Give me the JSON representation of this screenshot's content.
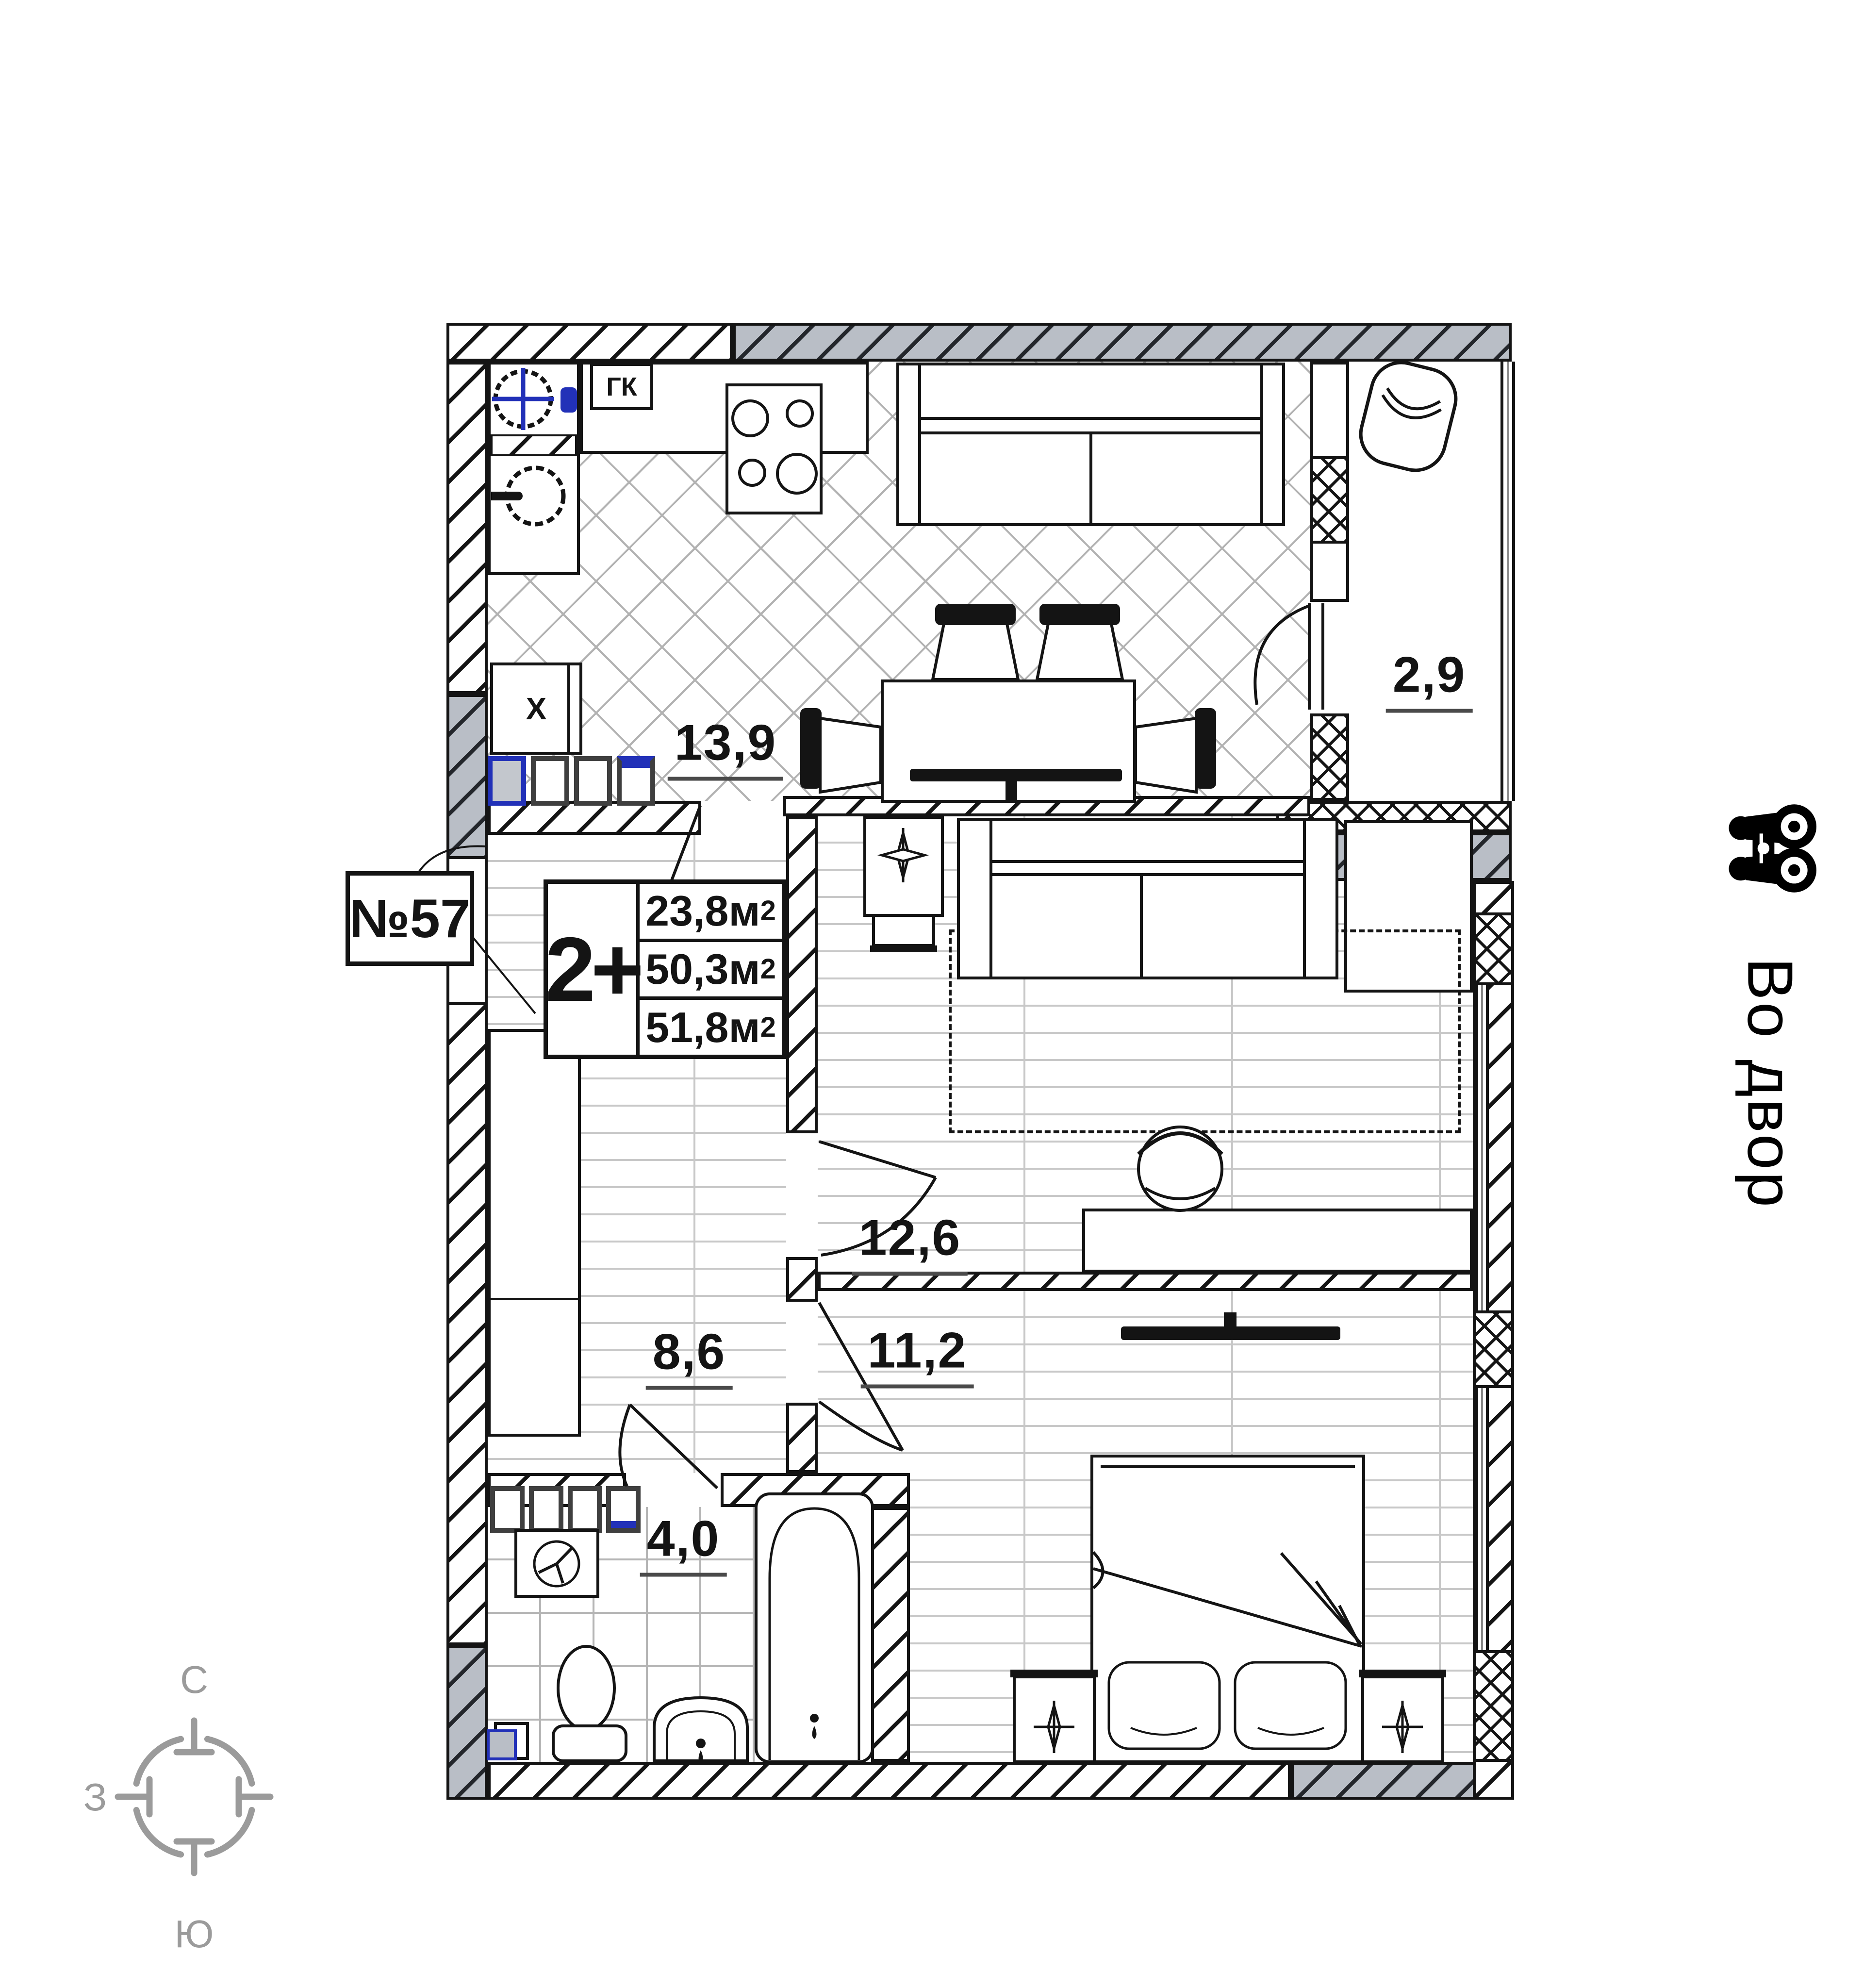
{
  "plan": {
    "apartment_number": "№57",
    "type_label": "2+",
    "areas": [
      {
        "value": "23,8",
        "unit": "м",
        "sup": "2"
      },
      {
        "value": "50,3",
        "unit": "м",
        "sup": "2"
      },
      {
        "value": "51,8",
        "unit": "м",
        "sup": "2"
      }
    ],
    "rooms": [
      {
        "id": "kitchen-living",
        "area": "13,9"
      },
      {
        "id": "balcony",
        "area": "2,9"
      },
      {
        "id": "room",
        "area": "12,6"
      },
      {
        "id": "bedroom",
        "area": "11,2"
      },
      {
        "id": "hall",
        "area": "8,6"
      },
      {
        "id": "bathroom",
        "area": "4,0"
      }
    ],
    "gas_boiler_label": "ГК",
    "fridge_label": "Х"
  },
  "compass": {
    "north": "С",
    "west": "З",
    "south": "Ю"
  },
  "view": {
    "label": "Во двор",
    "icon": "binoculars-icon"
  },
  "colors": {
    "accent_blue": "#2231b8",
    "wall_gray": "#b9bec6",
    "line_black": "#141414",
    "compass_gray": "#9b9b9b"
  }
}
